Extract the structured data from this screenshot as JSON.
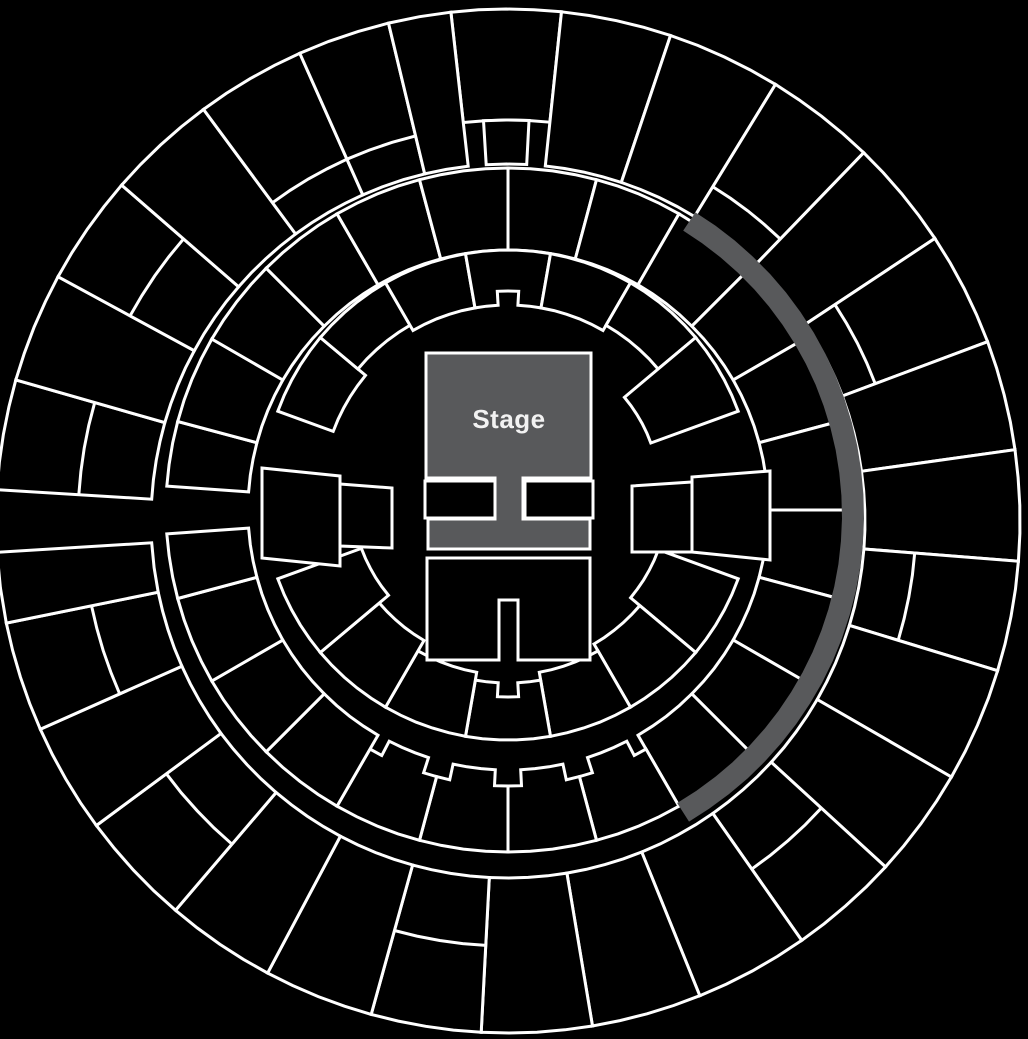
{
  "colors": {
    "background": "#000000",
    "line": "#ffffff",
    "section_fill": "#000000",
    "stage_fill": "#58595b",
    "highlight_fill": "#58595b",
    "label_color": "#f2f2f2",
    "line_width": 3
  },
  "map": {
    "stage": {
      "label": "Stage",
      "poly": [
        [
          426,
          353
        ],
        [
          591,
          353
        ],
        [
          591,
          478
        ],
        [
          523,
          478
        ],
        [
          523,
          519
        ],
        [
          590,
          519
        ],
        [
          590,
          549
        ],
        [
          428,
          549
        ],
        [
          428,
          519
        ],
        [
          495,
          519
        ],
        [
          495,
          478
        ],
        [
          426,
          478
        ]
      ],
      "label_pos": [
        509,
        428
      ]
    },
    "floor_sections": [
      {
        "name": "floor-box-left",
        "poly": [
          [
            425,
            481
          ],
          [
            495,
            481
          ],
          [
            495,
            518
          ],
          [
            425,
            518
          ]
        ]
      },
      {
        "name": "floor-box-right",
        "poly": [
          [
            525,
            481
          ],
          [
            593,
            481
          ],
          [
            593,
            518
          ],
          [
            525,
            518
          ]
        ]
      },
      {
        "name": "floor-rear",
        "poly": [
          [
            427,
            558
          ],
          [
            590,
            558
          ],
          [
            590,
            660
          ],
          [
            518,
            660
          ],
          [
            518,
            600
          ],
          [
            499,
            600
          ],
          [
            499,
            660
          ],
          [
            427,
            660
          ]
        ]
      },
      {
        "name": "side-box-east-1",
        "poly": [
          [
            632,
            486
          ],
          [
            692,
            482
          ],
          [
            692,
            552
          ],
          [
            632,
            552
          ]
        ]
      },
      {
        "name": "side-box-east-2",
        "poly": [
          [
            692,
            477
          ],
          [
            770,
            471
          ],
          [
            770,
            560
          ],
          [
            692,
            552
          ]
        ]
      },
      {
        "name": "side-box-west-1",
        "poly": [
          [
            262,
            468
          ],
          [
            340,
            476
          ],
          [
            340,
            566
          ],
          [
            262,
            558
          ]
        ]
      },
      {
        "name": "side-box-west-2",
        "poly": [
          [
            340,
            484
          ],
          [
            392,
            488
          ],
          [
            392,
            548
          ],
          [
            340,
            546
          ]
        ]
      }
    ],
    "rings": [
      {
        "name": "outer-ring",
        "cx": 508,
        "cy": 521,
        "rI": 357,
        "rO": 512,
        "sections": [
          {
            "a": [
              -96.4,
              -84
            ],
            "rI": 401
          },
          {
            "a": [
              -93.5,
              -87
            ],
            "rO": 401
          },
          {
            "a": [
              -84,
              -71.5
            ]
          },
          {
            "a": [
              -71.5,
              -58.5
            ]
          },
          {
            "a": [
              -58.5,
              -46
            ],
            "split": 392
          },
          {
            "a": [
              -46,
              -33.5
            ]
          },
          {
            "a": [
              -33.5,
              -20.5
            ],
            "split": 392
          },
          {
            "a": [
              -20.5,
              -8
            ]
          },
          {
            "a": [
              -8,
              4.5
            ]
          },
          {
            "a": [
              4.5,
              17
            ],
            "split": 408
          },
          {
            "a": [
              17,
              30
            ]
          },
          {
            "a": [
              30,
              42.5
            ]
          },
          {
            "a": [
              42.5,
              55
            ],
            "split": 425
          },
          {
            "a": [
              55,
              68
            ]
          },
          {
            "a": [
              68,
              80.5
            ]
          },
          {
            "a": [
              80.5,
              93
            ]
          },
          {
            "a": [
              93,
              105.5
            ],
            "split": 425
          },
          {
            "a": [
              105.5,
              118
            ]
          },
          {
            "a": [
              118,
              130.5
            ]
          },
          {
            "a": [
              130.5,
              143.5
            ],
            "split": 425
          },
          {
            "a": [
              143.5,
              156
            ]
          },
          {
            "a": [
              156,
              168.5
            ],
            "split": 425
          },
          {
            "a": [
              168.5,
              176.5
            ]
          },
          {
            "a": [
              183.5,
              196
            ],
            "split": 430
          },
          {
            "a": [
              196,
              208.5
            ]
          },
          {
            "a": [
              208.5,
              221
            ],
            "split": 430
          },
          {
            "a": [
              221,
              233.5
            ]
          },
          {
            "a": [
              233.5,
              246
            ],
            "split": 396
          },
          {
            "a": [
              246,
              256.5
            ],
            "split": 396
          },
          {
            "a": [
              256.5,
              263.6
            ]
          }
        ]
      },
      {
        "name": "middle-ring",
        "cx": 508,
        "cy": 510,
        "rI": 260,
        "rO": 342,
        "sections": [
          {
            "a": [
              -90,
              -75
            ]
          },
          {
            "a": [
              -75,
              -60
            ]
          },
          {
            "a": [
              -60,
              -45
            ]
          },
          {
            "a": [
              -45,
              -30
            ]
          },
          {
            "a": [
              -30,
              -15
            ]
          },
          {
            "a": [
              -15,
              0
            ]
          },
          {
            "a": [
              0,
              15
            ]
          },
          {
            "a": [
              15,
              30
            ]
          },
          {
            "a": [
              30,
              45
            ]
          },
          {
            "a": [
              45,
              60
            ]
          },
          {
            "a": [
              60,
              75
            ],
            "corner": true
          },
          {
            "a": [
              75,
              90
            ],
            "corner": true
          },
          {
            "a": [
              90,
              105
            ],
            "corner": true
          },
          {
            "a": [
              105,
              120
            ],
            "corner": true
          },
          {
            "a": [
              120,
              135
            ]
          },
          {
            "a": [
              135,
              150
            ]
          },
          {
            "a": [
              150,
              165
            ]
          },
          {
            "a": [
              165,
              176
            ]
          },
          {
            "a": [
              184,
              195
            ]
          },
          {
            "a": [
              195,
              210
            ]
          },
          {
            "a": [
              210,
              225
            ]
          },
          {
            "a": [
              225,
              240
            ]
          },
          {
            "a": [
              240,
              255
            ]
          },
          {
            "a": [
              255,
              270
            ]
          }
        ]
      },
      {
        "name": "lower-bowl",
        "cx": 508,
        "cy": 495,
        "rI": 190,
        "rO": 245,
        "sections": [
          {
            "a": [
              20,
              40
            ],
            "rI": 160
          },
          {
            "a": [
              40,
              60
            ],
            "rI": 172
          },
          {
            "a": [
              60,
              80
            ],
            "rI": 180
          },
          {
            "a": [
              80,
              100
            ],
            "rI": 188,
            "notch": true
          },
          {
            "a": [
              100,
              120
            ],
            "rI": 180
          },
          {
            "a": [
              120,
              140
            ],
            "rI": 168
          },
          {
            "a": [
              140,
              160
            ],
            "rI": 156
          },
          {
            "a": [
              200,
              220
            ],
            "rI": 186
          },
          {
            "a": [
              220,
              240
            ],
            "rI": 196
          },
          {
            "a": [
              240,
              260
            ],
            "rI": 190
          },
          {
            "a": [
              260,
              280
            ],
            "rI": 190,
            "notch": true
          },
          {
            "a": [
              280,
              300
            ],
            "rI": 190
          },
          {
            "a": [
              300,
              320
            ],
            "rI": 196
          },
          {
            "a": [
              320,
              340
            ],
            "rI": 152
          }
        ]
      }
    ],
    "highlight_arc": {
      "cx": 508,
      "cy": 515,
      "r": 345,
      "width": 22,
      "a0": -58.3,
      "a1": 59.5
    }
  }
}
